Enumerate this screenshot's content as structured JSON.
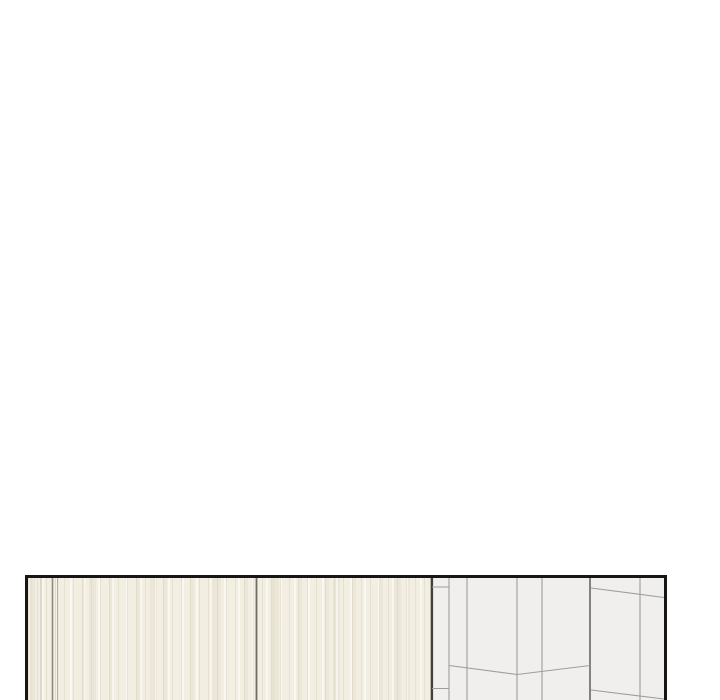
{
  "scene": {
    "type": "webtoon-panel-crop",
    "description": "Blank white vertical-scroll comic page; only the top edge of a panel is visible at the bottom: cream wooden wardrobe doors on the left, a light-gray tiled wall corner in perspective on the right, framed by a dark panel border cut off by the bottom of the image.",
    "page_background": "#ffffff"
  },
  "panel": {
    "x": 25,
    "y": 575,
    "width": 642,
    "height": 125,
    "border_width": 3,
    "border_color": "#161614"
  },
  "interior": {
    "width": 636,
    "height": 122
  },
  "wardrobe": {
    "width": 403,
    "base_color": "#f2eee1",
    "streaks": [
      {
        "color": "rgba(214,206,186,0.45)",
        "line": 1,
        "period": 9
      },
      {
        "color": "rgba(255,255,255,0.55)",
        "line": 2,
        "period": 14
      },
      {
        "color": "rgba(222,214,194,0.30)",
        "line": 4,
        "period": 27
      },
      {
        "color": "rgba(205,197,175,0.18)",
        "line": 7,
        "period": 61
      }
    ],
    "seams": [
      {
        "x": 13,
        "w": 1.0,
        "color": "#c6c2b5"
      },
      {
        "x": 24.5,
        "w": 1.6,
        "color": "#8d8a80"
      },
      {
        "x": 29.5,
        "w": 1.0,
        "color": "#b3afa2"
      },
      {
        "x": 228.5,
        "w": 1.8,
        "color": "#6f6d65"
      }
    ],
    "edge": {
      "x": 402.7,
      "w": 2.4,
      "color": "#3f3f3b"
    }
  },
  "tiles": {
    "x": 403,
    "width": 233,
    "base_color": "#f0efed",
    "grout_color": "#9d9d99",
    "grout_width": 1.1,
    "corner_color": "#7c7c78",
    "corner_width": 1.9,
    "vertical_grout_x": [
      421,
      439,
      489,
      514,
      612
    ],
    "corner_x": 562,
    "strip_lines": [
      {
        "x1": 404,
        "y1": 9,
        "x2": 421,
        "y2": 9
      },
      {
        "x1": 404,
        "y1": 110.5,
        "x2": 421,
        "y2": 110.5
      }
    ],
    "chevron_points": [
      [
        421,
        87.5
      ],
      [
        489,
        96.5
      ],
      [
        562,
        87.5
      ]
    ],
    "slant_lines": [
      {
        "x1": 563,
        "y1": 10,
        "x2": 636,
        "y2": 19.5
      },
      {
        "x1": 563,
        "y1": 112,
        "x2": 636,
        "y2": 121
      }
    ]
  }
}
